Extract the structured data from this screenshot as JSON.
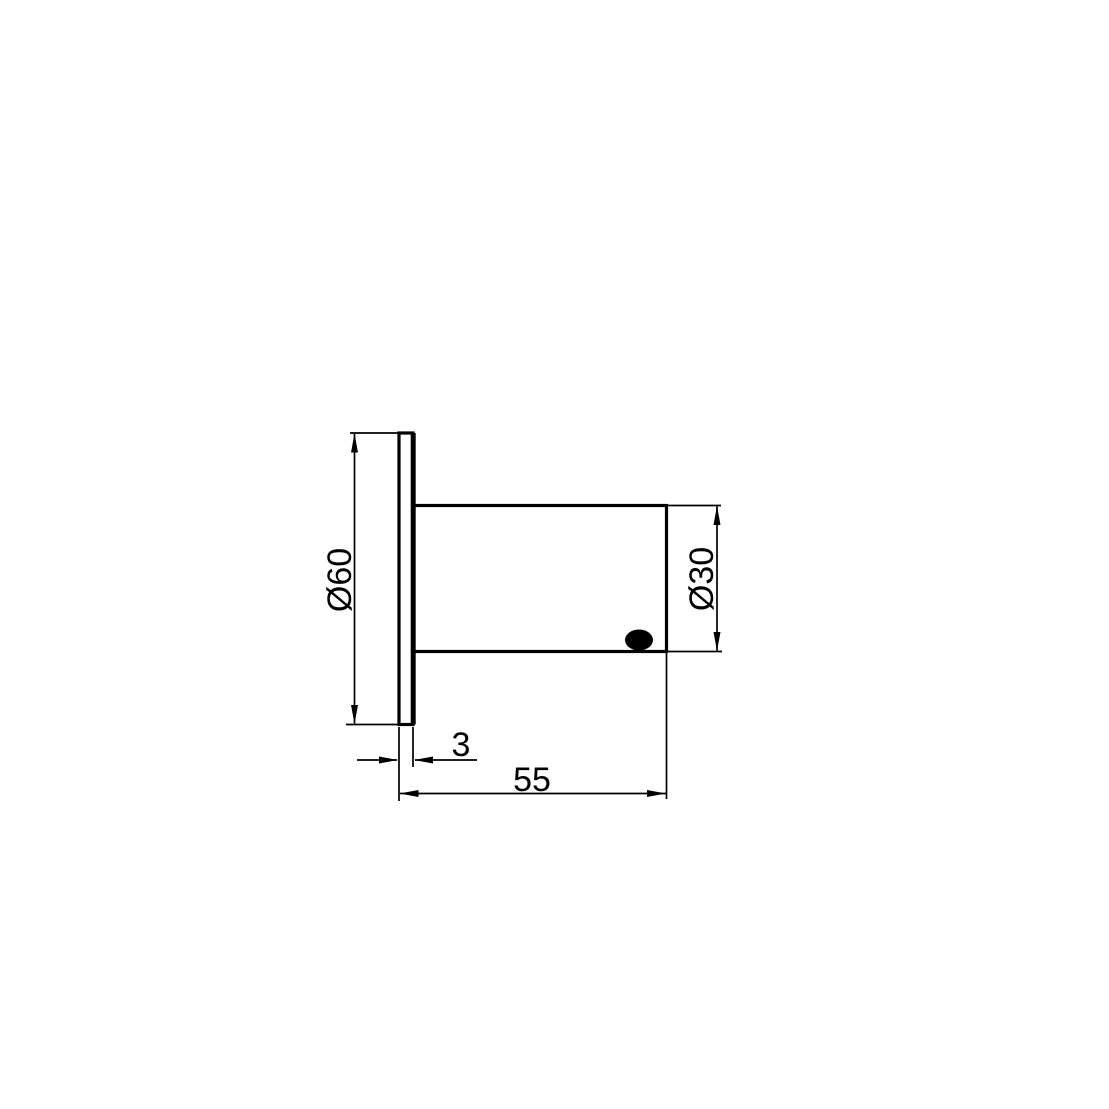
{
  "colors": {
    "ink": "#000000",
    "paper": "#ffffff"
  },
  "dimensions": {
    "flange_diameter": {
      "label": "Ø60",
      "value": 60
    },
    "body_diameter": {
      "label": "Ø30",
      "value": 30
    },
    "flange_thickness": {
      "label": "3",
      "value": 3
    },
    "overall_length": {
      "label": "55",
      "value": 55
    }
  },
  "shapes": {
    "flange": "flange-plate-side-view",
    "body": "cylindrical-body-side-view",
    "dot": "filled-hole-marker"
  }
}
